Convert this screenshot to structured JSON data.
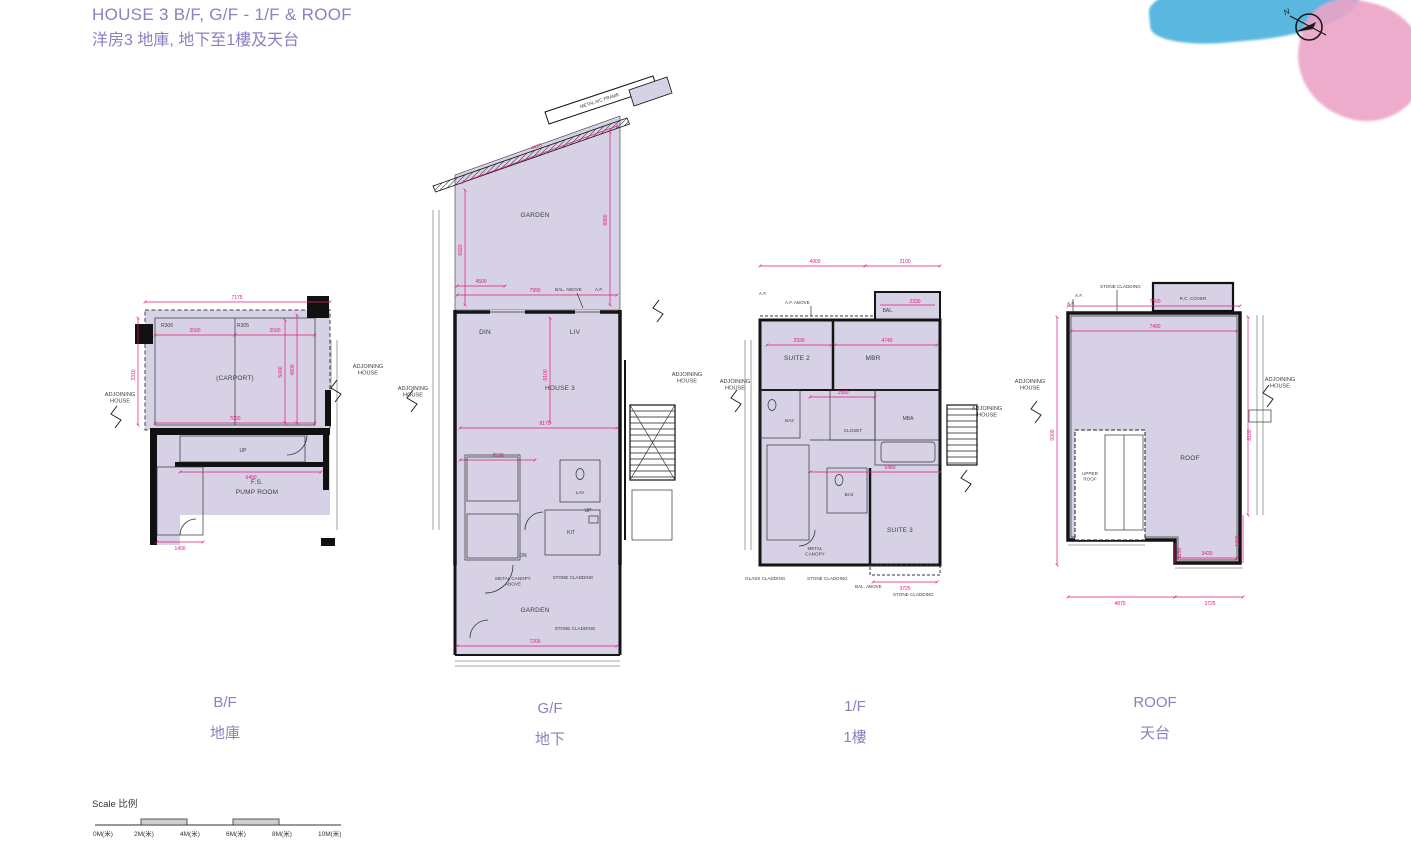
{
  "page": {
    "title_en": "HOUSE 3  B/F, G/F - 1/F & ROOF",
    "title_zh": "洋房3  地庫, 地下至1樓及天台",
    "north_label": "N"
  },
  "colors": {
    "accent_purple": "#8b80c0",
    "dimension_pink": "#e2187d",
    "plan_fill": "#d7d1e5",
    "wall_black": "#141414",
    "watercolor_blue": "#49b0dc",
    "watercolor_pink": "#eda4c8"
  },
  "floors": [
    {
      "name": "B/F",
      "name_zh": "地庫",
      "rooms": {
        "stall_left": "R306",
        "stall_right": "R305",
        "carport": "(CARPORT)",
        "up": "UP",
        "pump1": "F.S.",
        "pump2": "PUMP ROOM"
      },
      "adjoining_left": "ADJOINING\nHOUSE",
      "adjoining_right": "ADJOINING\nHOUSE",
      "dims": {
        "top": "7175",
        "stall_l": "2500",
        "stall_r": "2500",
        "mid": "7000",
        "low": "6400",
        "left_v": "3310",
        "right_v1": "5000",
        "right_v2": "4800",
        "bottom": "1400"
      }
    },
    {
      "name": "G/F",
      "name_zh": "地下",
      "rooms": {
        "garden_top": "GARDEN",
        "din": "DIN",
        "liv": "LIV",
        "house": "HOUSE 3",
        "lav": "LAV",
        "up": "UP",
        "dn": "DN",
        "kit": "KIT",
        "garden_bottom": "GARDEN"
      },
      "annotations": {
        "ac_frame": "METAL A/C FRAME",
        "af1": "A.F.",
        "stone1": "STONE CLADDING",
        "bal_above": "BAL. ABOVE",
        "af2": "A.F.",
        "canopy": "METAL CANOPY\nABOVE",
        "stone2": "STONE CLADDING",
        "stone3": "STONE CLADDING"
      },
      "adjoining_left": "ADJOINING\nHOUSE",
      "adjoining_right": "ADJOINING\nHOUSE",
      "dims": {
        "diag": "4420",
        "left_v": "6920",
        "right_v": "8980",
        "g1": "4500",
        "g2": "7990",
        "house_v": "9100",
        "house_h": "8170",
        "b1": "2530",
        "bottom": "7200"
      }
    },
    {
      "name": "1/F",
      "name_zh": "1樓",
      "rooms": {
        "bal": "BAL.",
        "suite2": "SUITE 2",
        "mbr": "MBR",
        "ba2": "BA2",
        "closet": "CLOSET",
        "mba": "MBA",
        "ba3": "BA3",
        "suite3": "SUITE 3"
      },
      "annotations": {
        "af_above": "A.F. ABOVE",
        "af": "A.F.",
        "canopy": "METAL\nCANOPY",
        "glass": "GLASS CLADDING",
        "stone1": "STONE CLADDING",
        "bal_above": "BAL. ABOVE",
        "stone2": "STONE CLADDING"
      },
      "adjoining_left": "ADJOINING\nHOUSE",
      "adjoining_right": "ADJOINING\nHOUSE",
      "dims": {
        "top1": "4900",
        "top2": "2100",
        "bal": "2330",
        "r1": "2930",
        "r2": "4740",
        "m1": "1500",
        "s1": "5480",
        "bottom": "3725"
      }
    },
    {
      "name": "ROOF",
      "name_zh": "天台",
      "rooms": {
        "roof": "ROOF",
        "upper_roof": "UPPER\nROOF"
      },
      "annotations": {
        "stone": "STONE CLADDING",
        "rc_cover": "R.C. COVER",
        "af1": "A.F.",
        "af2": "A.F."
      },
      "adjoining_left": "ADJOINING\nHOUSE",
      "adjoining_right": "ADJOINING\nHOUSE",
      "dims": {
        "top": "7500",
        "inner": "7400",
        "left_v": "5000",
        "right_v": "8100",
        "b1": "4875",
        "b2": "3725",
        "b3": "3420",
        "s1": "1150",
        "s2": "1700"
      }
    }
  ],
  "scale_bar": {
    "label": "Scale 比例",
    "ticks": [
      "0M(米)",
      "2M(米)",
      "4M(米)",
      "6M(米)",
      "8M(米)",
      "10M(米)"
    ]
  }
}
